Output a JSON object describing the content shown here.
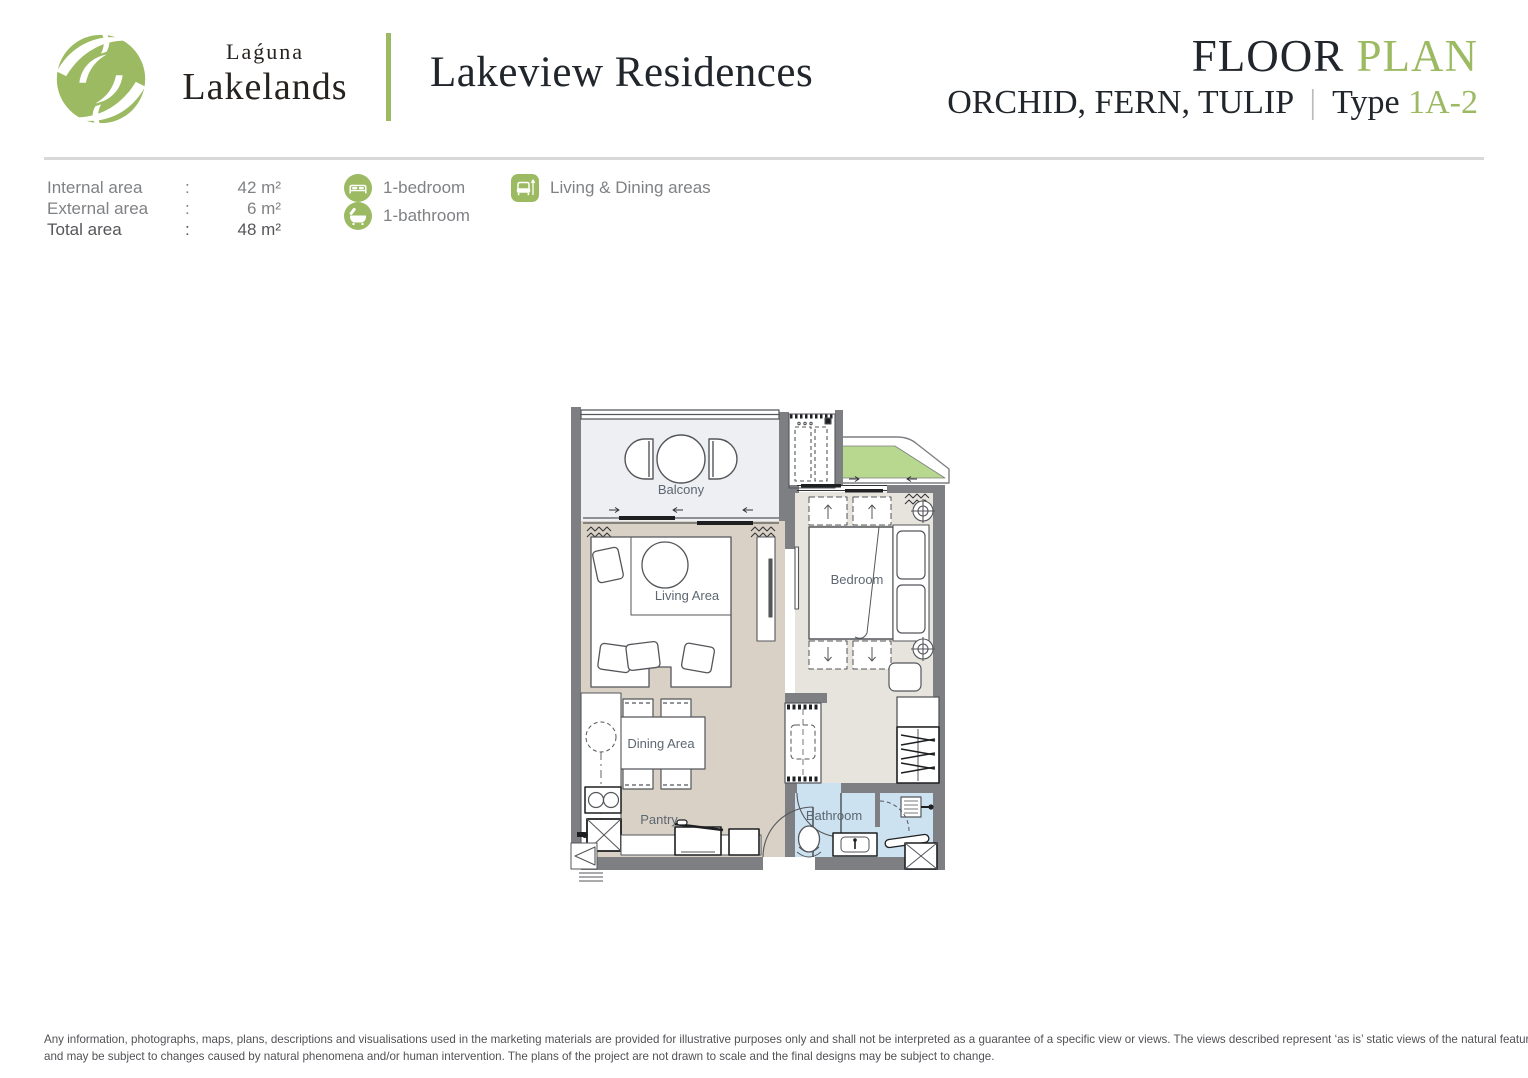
{
  "colors": {
    "accent_green": "#9bba61",
    "planter_green": "#b7d88e",
    "wall_gray": "#7d7f83",
    "floor_living": "#d9d1c5",
    "floor_bedroom": "#e7e4de",
    "floor_balcony": "#edeff2",
    "floor_bathroom": "#cde2f1",
    "divider_gray": "#d8d8d8"
  },
  "header": {
    "brand_top": "Laǵuna",
    "brand_bottom": "Lakelands",
    "project_name": "Lakeview Residences",
    "title_dark": "FLOOR",
    "title_green": "PLAN",
    "subtitle_dark": "ORCHID, FERN, TULIP",
    "subtitle_divider": "|",
    "subtitle_type": "Type",
    "subtitle_code": "1A-2"
  },
  "areas": {
    "rows": [
      {
        "label": "Internal area",
        "colon": ":",
        "value": "42 m²"
      },
      {
        "label": "External area",
        "colon": ":",
        "value": "6 m²"
      },
      {
        "label": "Total area",
        "colon": ":",
        "value": "48 m²"
      }
    ]
  },
  "legend": {
    "items": [
      {
        "icon": "bed-icon",
        "label": "1-bedroom"
      },
      {
        "icon": "bathtub-icon",
        "label": "1-bathroom"
      },
      {
        "icon": "sofa-icon",
        "label": "Living & Dining areas"
      }
    ]
  },
  "floorplan": {
    "labels": {
      "balcony": "Balcony",
      "living": "Living Area",
      "dining": "Dining Area",
      "pantry": "Pantry",
      "bedroom": "Bedroom",
      "bathroom": "Bathroom"
    }
  },
  "footer": {
    "line1": "Any information, photographs, maps, plans, descriptions and visualisations used in the marketing materials are provided for illustrative purposes only and shall not be interpreted as a guarantee of a specific view or views. The views described represent ‘as is’ static views of the natural features",
    "line2": "and may be subject to changes caused by natural phenomena and/or human intervention. The plans of the project are not drawn to scale and the final designs may be subject to change."
  }
}
